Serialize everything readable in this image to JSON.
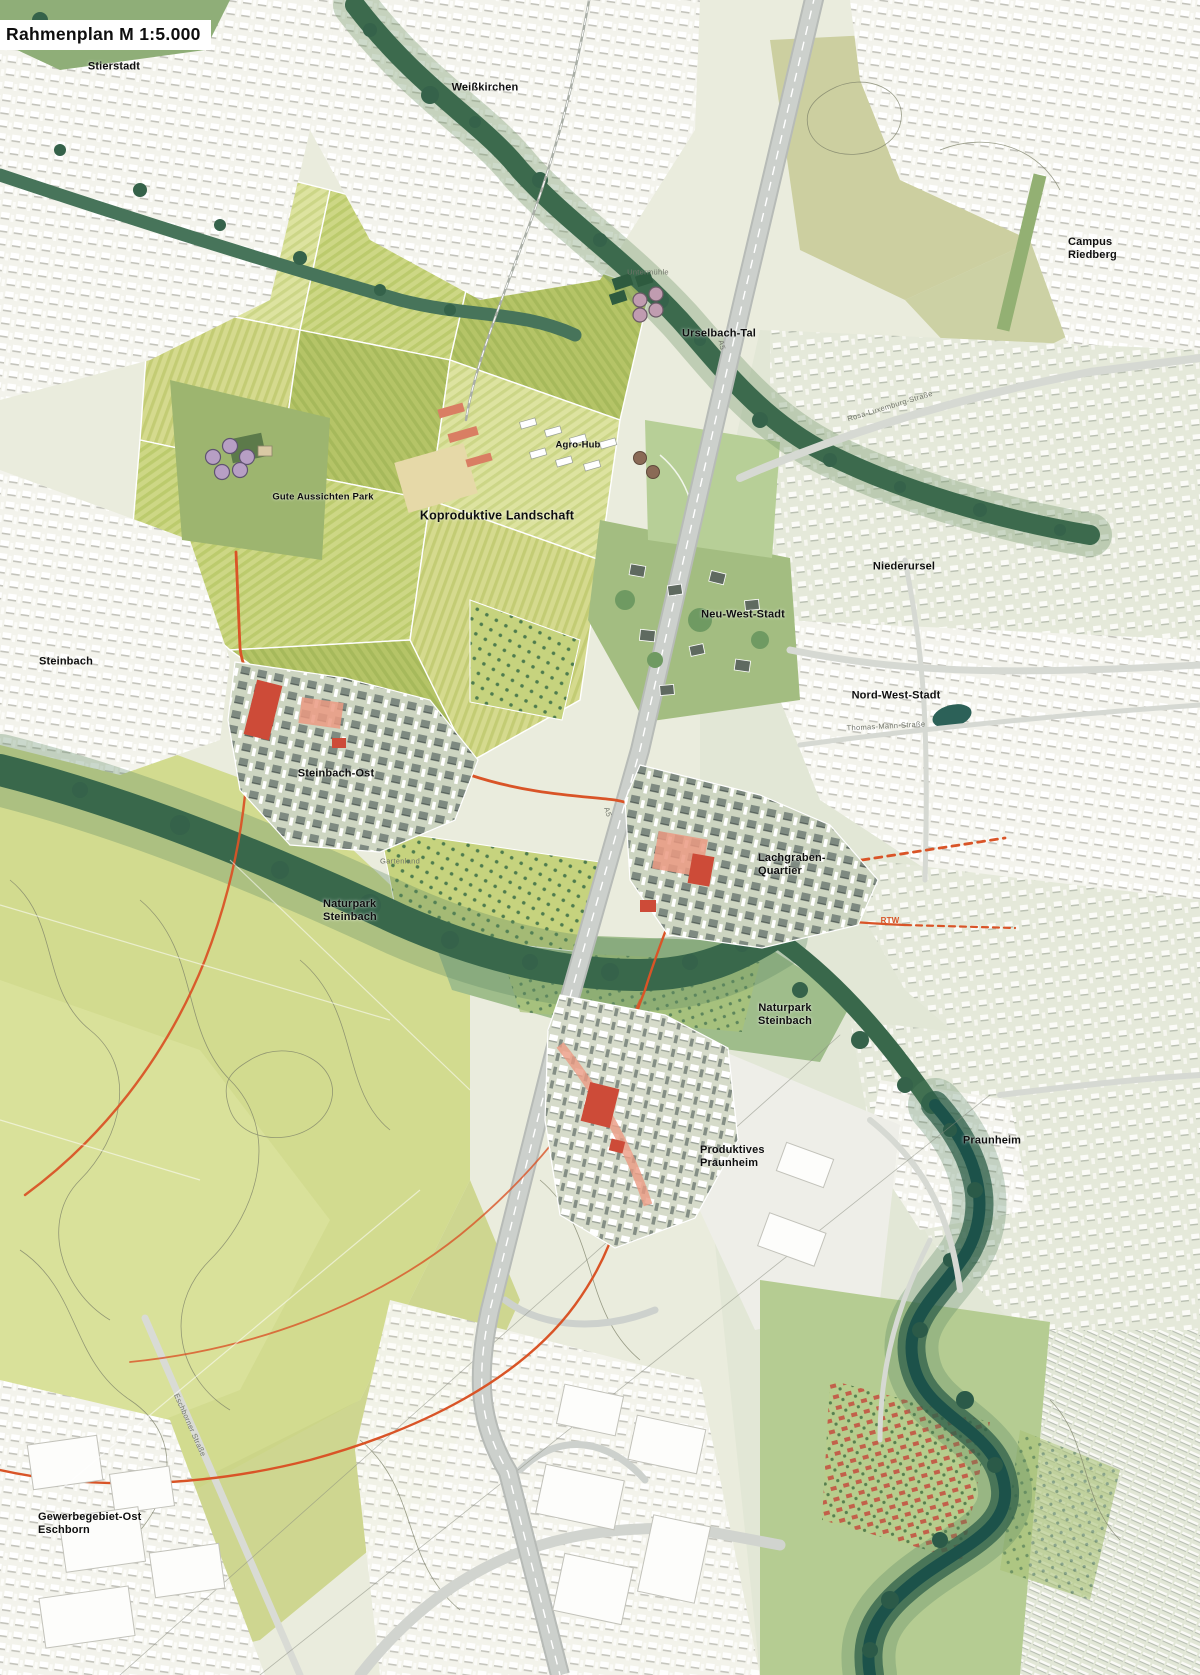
{
  "title": "Rahmenplan M 1:5.000",
  "regions": {
    "stierstadt": "Stierstadt",
    "weisskirchen": "Weißkirchen",
    "campus_riedberg": "Campus Riedberg",
    "urselbach_tal": "Urselbach-Tal",
    "agro_hub": "Agro-Hub",
    "gute_aussichten_park": "Gute Aussichten Park",
    "koproduktive_landschaft": "Koproduktive Landschaft",
    "niederursel": "Niederursel",
    "neu_west_stadt": "Neu-West-Stadt",
    "nord_west_stadt": "Nord-West-Stadt",
    "steinbach": "Steinbach",
    "steinbach_ost": "Steinbach-Ost",
    "lachgraben_quartier": "Lachgraben-\nQuartier",
    "naturpark_steinbach_west": "Naturpark\nSteinbach",
    "naturpark_steinbach_ost": "Naturpark\nSteinbach",
    "praunheim": "Praunheim",
    "produktives_praunheim": "Produktives\nPraunheim",
    "gewerbegebiet_ost_eschborn": "Gewerbegebiet-Ost\nEschborn"
  },
  "minor_labels": {
    "untermuehle": "Untermühle",
    "gartenland": "Gartenland",
    "thomas_mann_strasse": "Thomas-Mann-Straße",
    "rosa_luxemburg_strasse": "Rosa-Luxemburg-Straße",
    "eschborner_strasse": "Eschborner Straße",
    "a5_north": "A5",
    "a5_south": "A5",
    "rtw": "RTW"
  },
  "colors": {
    "rtw_orange": "#d95427",
    "quarter_red": "#cd4b38",
    "plaza_salmon": "#eb9a82",
    "woodland_green": "#3c6a4d",
    "river_teal": "#1c524a",
    "field_green": "#cdd785",
    "highway_gray": "#c7cbc7",
    "urban_white": "#f3f3ec",
    "urban_sage": "#e5e9da"
  }
}
